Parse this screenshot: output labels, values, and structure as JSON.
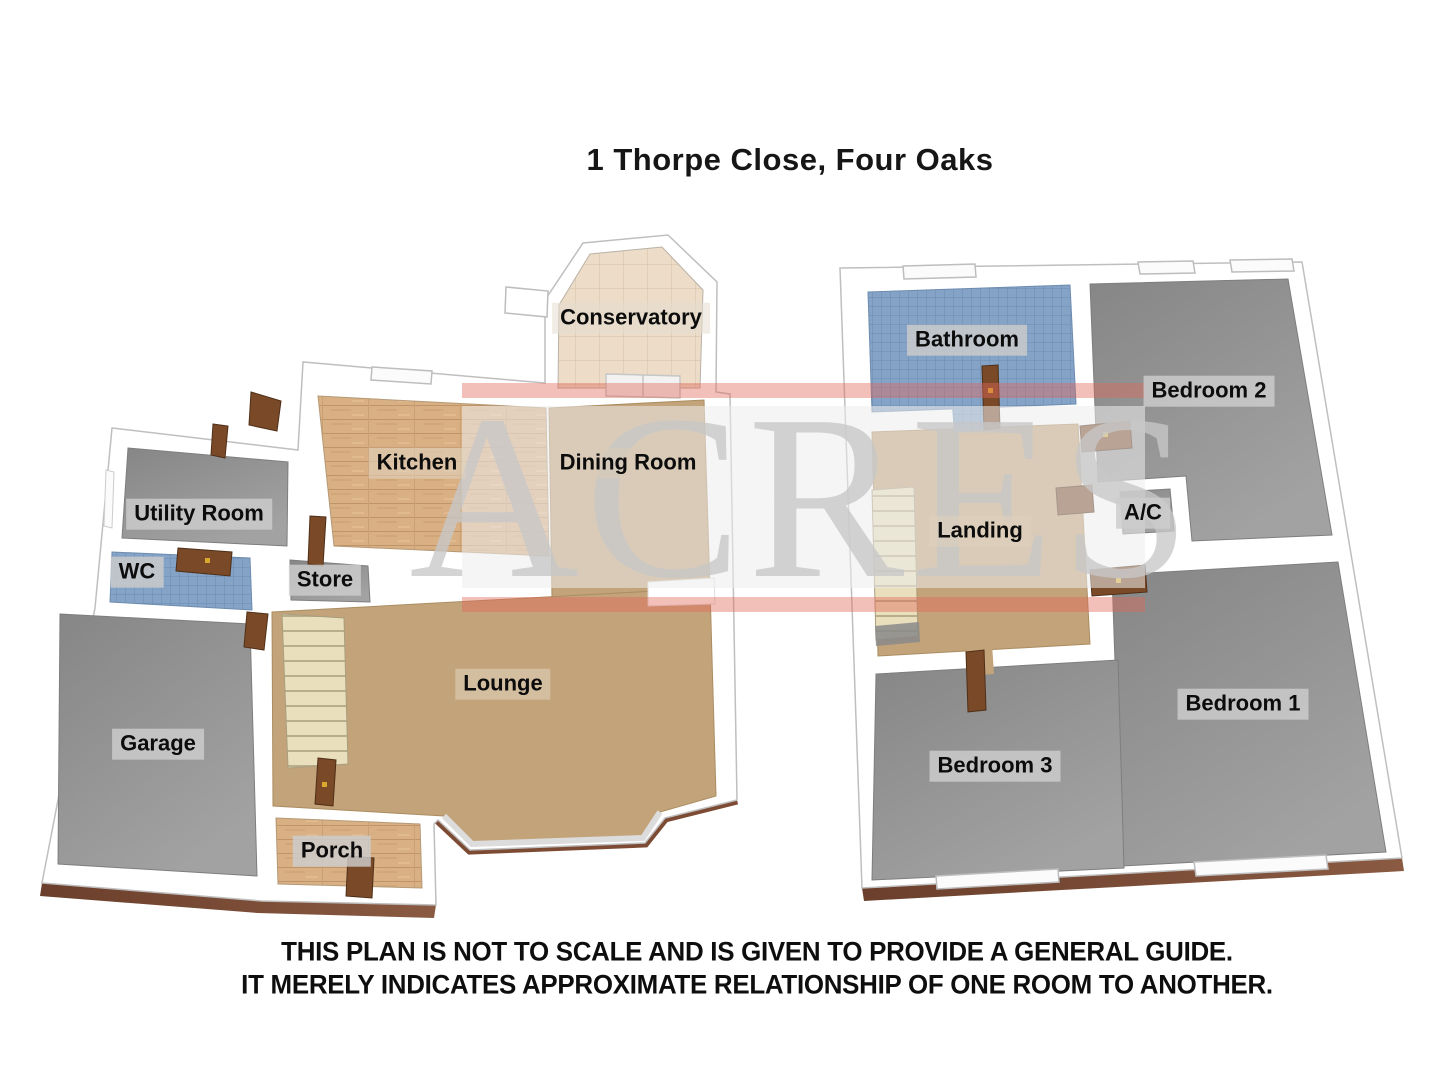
{
  "title": "1 Thorpe Close, Four Oaks",
  "watermark": {
    "text": "ACRES",
    "band_color": "#e8e8e8",
    "stripe_color": "#e36758"
  },
  "disclaimer": {
    "line1": "THIS PLAN IS NOT TO SCALE AND IS GIVEN TO PROVIDE A GENERAL GUIDE.",
    "line2": "IT MERELY INDICATES APPROXIMATE RELATIONSHIP OF ONE ROOM TO ANOTHER."
  },
  "floors": {
    "ground": {
      "rooms": [
        {
          "id": "conservatory",
          "label": "Conservatory",
          "floor": "cream-tile"
        },
        {
          "id": "kitchen",
          "label": "Kitchen",
          "floor": "wood"
        },
        {
          "id": "dining-room",
          "label": "Dining Room",
          "floor": "carpet"
        },
        {
          "id": "utility-room",
          "label": "Utility Room",
          "floor": "gray"
        },
        {
          "id": "wc",
          "label": "WC",
          "floor": "blue-tile"
        },
        {
          "id": "store",
          "label": "Store",
          "floor": "gray"
        },
        {
          "id": "lounge",
          "label": "Lounge",
          "floor": "carpet"
        },
        {
          "id": "garage",
          "label": "Garage",
          "floor": "gray"
        },
        {
          "id": "porch",
          "label": "Porch",
          "floor": "wood"
        }
      ]
    },
    "first": {
      "rooms": [
        {
          "id": "bathroom",
          "label": "Bathroom",
          "floor": "blue-tile"
        },
        {
          "id": "bedroom-2",
          "label": "Bedroom 2",
          "floor": "gray"
        },
        {
          "id": "landing",
          "label": "Landing",
          "floor": "carpet"
        },
        {
          "id": "ac",
          "label": "A/C",
          "floor": "gray"
        },
        {
          "id": "bedroom-1",
          "label": "Bedroom 1",
          "floor": "gray"
        },
        {
          "id": "bedroom-3",
          "label": "Bedroom 3",
          "floor": "gray"
        }
      ]
    }
  },
  "colors": {
    "wall": "#ffffff",
    "brick_edge": "#7d4b33",
    "door": "#7a4a28",
    "carpet": "#c3a379",
    "wood": "#d9b084",
    "tile_blue": "#84a3c6",
    "tile_cream": "#ecdcc8",
    "floor_gray": "#919191",
    "stairs": "#e9dfbc",
    "label_background": "#cdcdcd"
  }
}
